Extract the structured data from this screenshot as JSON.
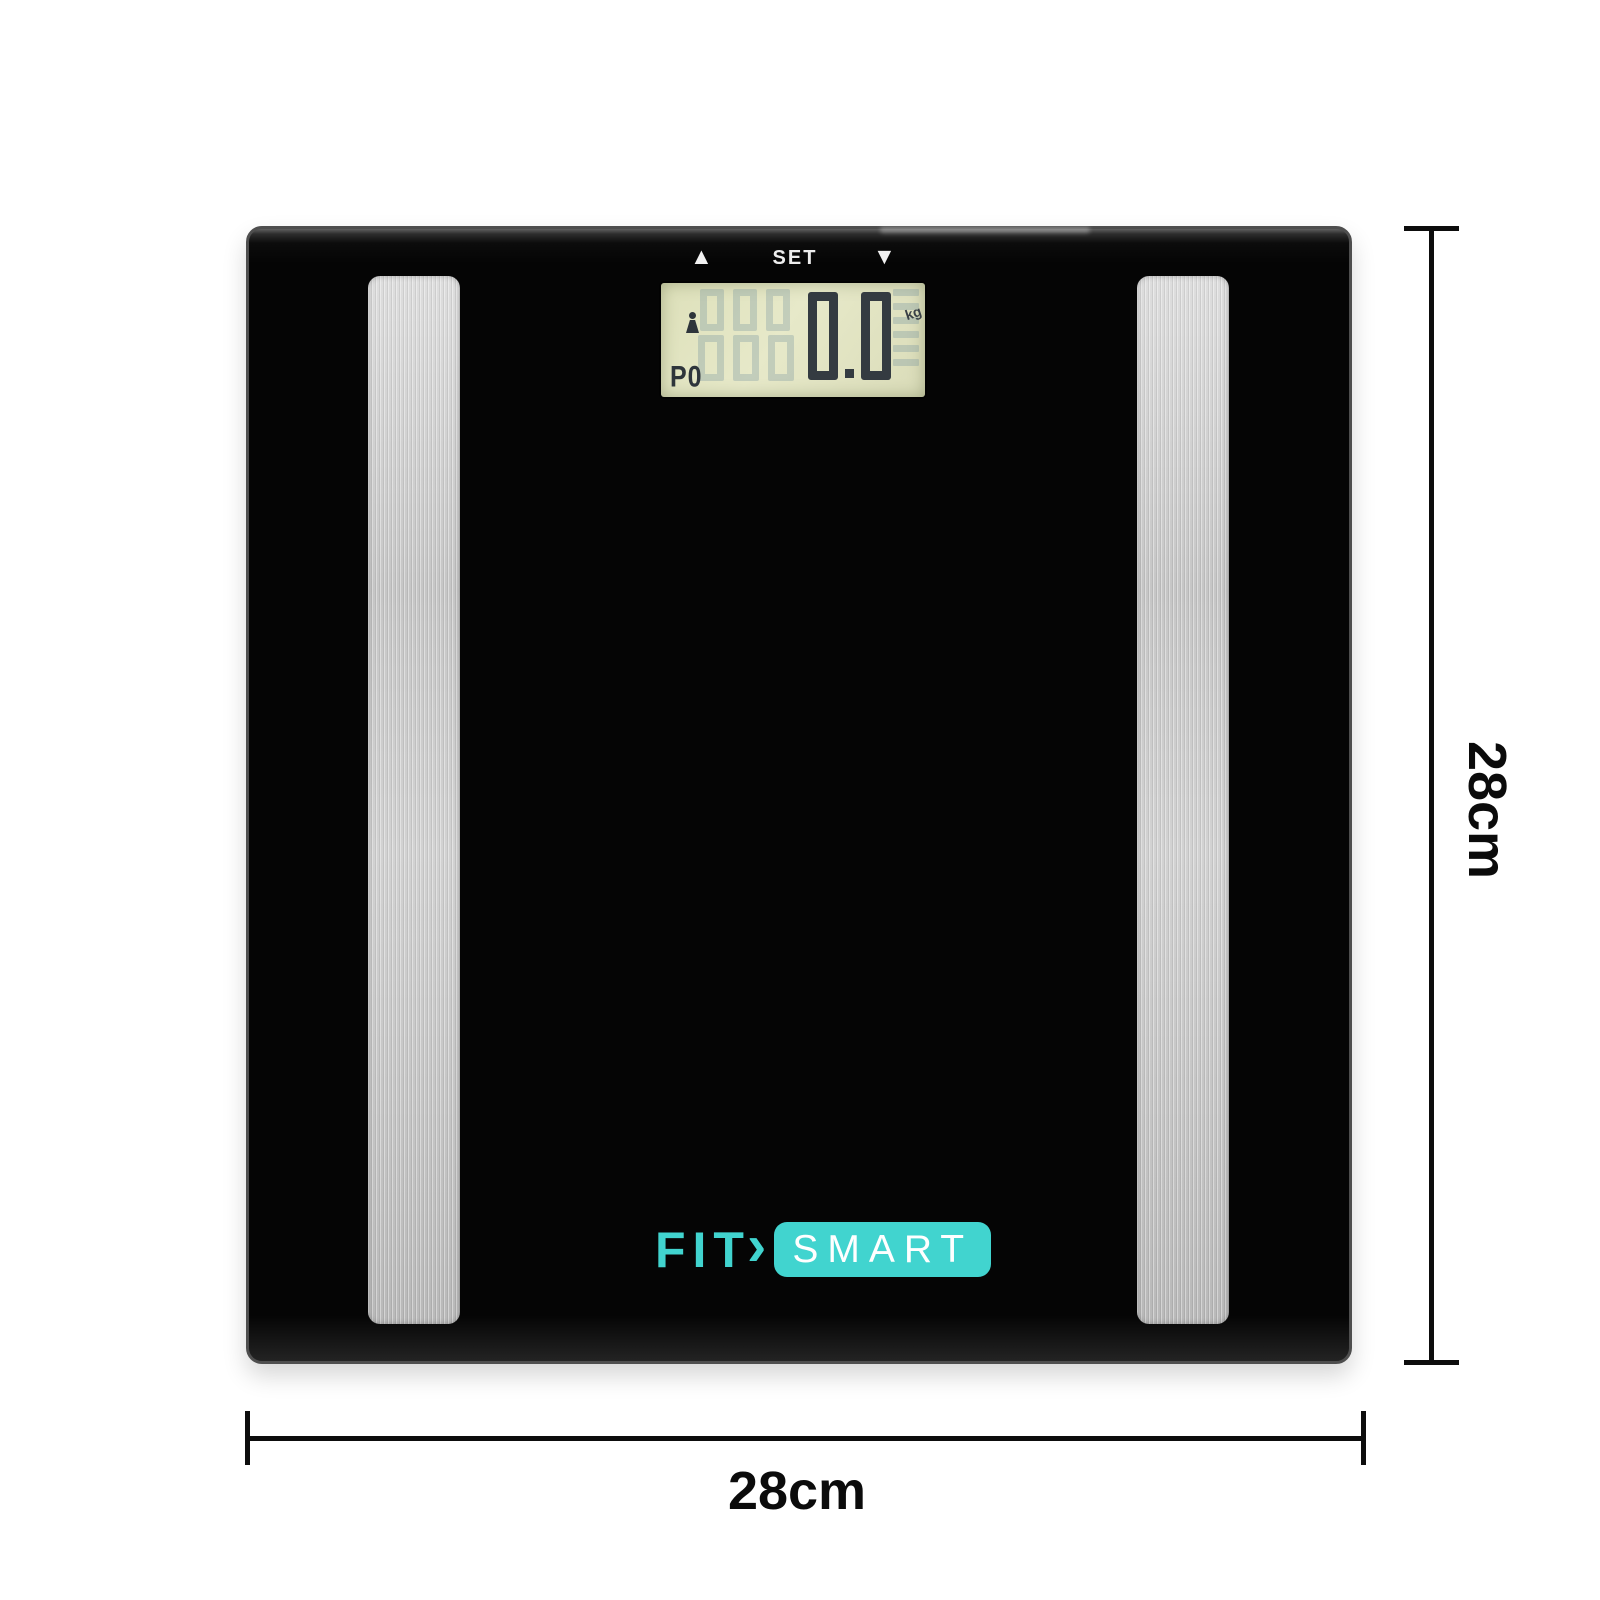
{
  "scale": {
    "controls": {
      "up_icon": "▲",
      "set_label": "SET",
      "down_icon": "▼"
    },
    "display": {
      "weight": "0.0",
      "unit": "kg",
      "mode": "P0"
    }
  },
  "brand": {
    "fit": "FIT",
    "chevron": "›",
    "smart": "SMART"
  },
  "dimensions": {
    "height_label": "28cm",
    "width_label": "28cm"
  },
  "colors": {
    "accent_teal": "#41d4cf",
    "lcd_background": "#e3e5c3",
    "body_black": "#060606",
    "strip_silver": "#cccccc",
    "lcd_digit": "#343b41"
  }
}
